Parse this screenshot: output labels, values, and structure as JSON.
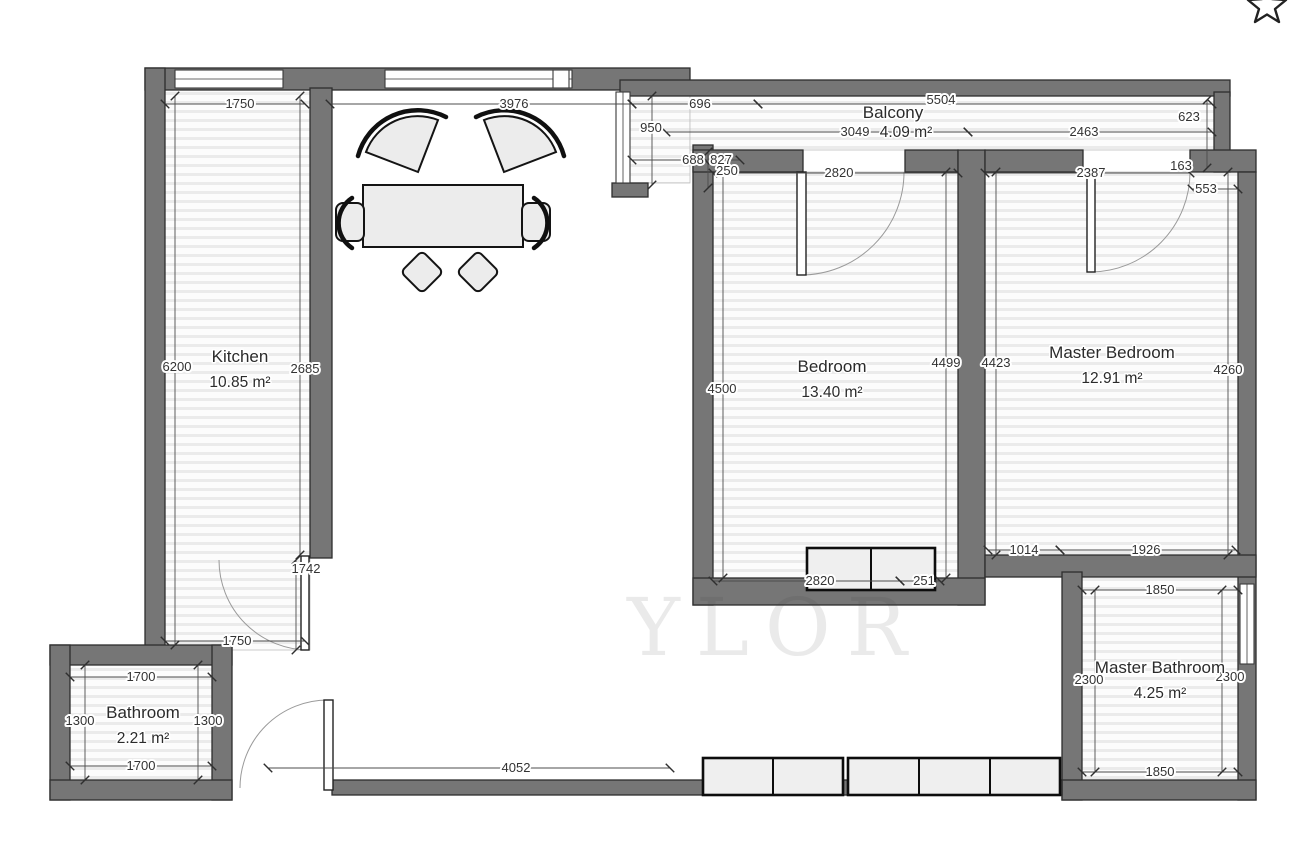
{
  "plan_title": "Apartment floor plan",
  "rooms": {
    "kitchen": {
      "name": "Kitchen",
      "area": "10.85 m²"
    },
    "bedroom": {
      "name": "Bedroom",
      "area": "13.40 m²"
    },
    "master_bedroom": {
      "name": "Master Bedroom",
      "area": "12.91 m²"
    },
    "master_bathroom": {
      "name": "Master Bathroom",
      "area": "4.25 m²"
    },
    "bathroom": {
      "name": "Bathroom",
      "area": "2.21 m²"
    },
    "balcony": {
      "name": "Balcony",
      "area": "4.09 m²"
    }
  },
  "dims": {
    "kitchen_top": "1750",
    "living_top": "3976",
    "balcony_left_w": "696",
    "balcony_total_w": "5504",
    "balcony_seg_left": "3049",
    "balcony_seg_right": "2463",
    "balcony_left_h": "950",
    "balcony_right_h": "623",
    "jog_a": "688",
    "jog_b": "827",
    "bedroom_wall_offset": "250",
    "bedroom_top_w": "2820",
    "master_top_w": "2387",
    "master_jog": "163",
    "master_inset": "553",
    "kitchen_left_h": "6200",
    "kitchen_right_h": "2685",
    "bedroom_left_h": "4500",
    "bedroom_right_h": "4499",
    "master_left_h": "4423",
    "master_right_h": "4260",
    "master_bottom_left": "1014",
    "master_bottom_right": "1926",
    "closet_w": "2820",
    "closet_d": "251",
    "kitchen_door_h": "1742",
    "kitchen_bottom_w": "1750",
    "mbath_top_w": "1850",
    "mbath_left_h": "2300",
    "mbath_right_h": "2300",
    "mbath_bottom_w": "1850",
    "bath_top_w": "1700",
    "bath_left_h": "1300",
    "bath_right_h": "1300",
    "bath_bottom_w": "1700",
    "hall_w": "4052"
  },
  "watermark": "YLOR",
  "icons": {
    "favorite_star": "star-outline"
  },
  "colors": {
    "wall": "#767676",
    "wall_outline": "#2e2e2e",
    "floor_stripe": "#ebebeb",
    "dim_line": "#4c4c4c",
    "text": "#333333"
  }
}
